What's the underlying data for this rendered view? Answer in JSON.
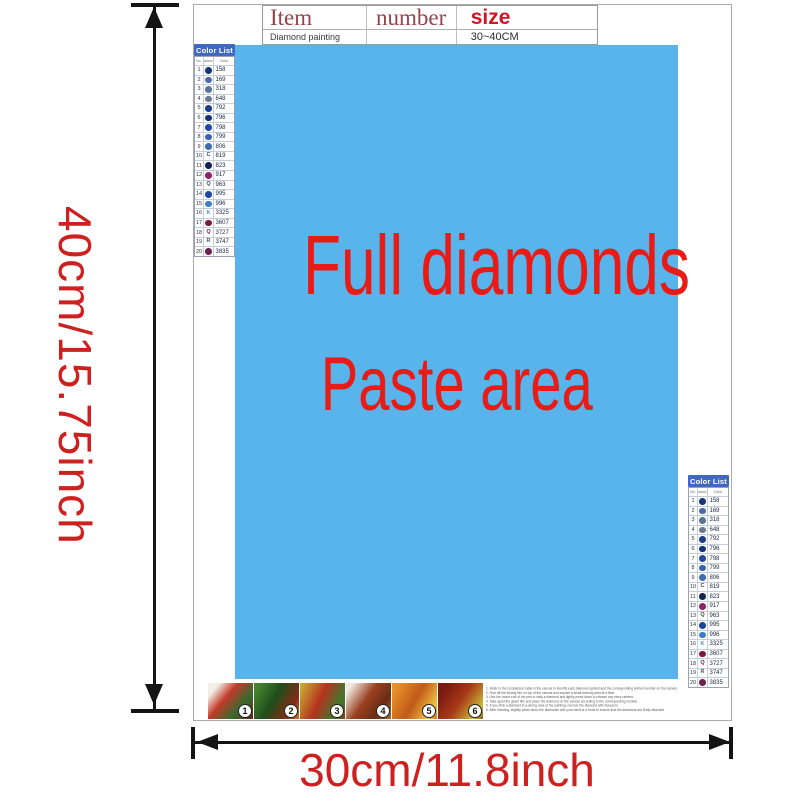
{
  "title_table": {
    "headers": [
      "Item",
      "number",
      "size"
    ],
    "row": [
      "Diamond painting",
      "",
      "30~40CM"
    ]
  },
  "paste_area": {
    "line1": "Full diamonds",
    "line2": "Paste area",
    "bg_color": "#58b4ea",
    "text_color": "#e81b17"
  },
  "dimensions": {
    "height_label": "40cm/15.75inch",
    "width_label": "30cm/11.8inch",
    "color": "#cf2020"
  },
  "color_list": {
    "title": "Color List",
    "header_bg": "#4068c0",
    "columns": [
      "No.",
      "Diamond",
      "Color"
    ],
    "rows": [
      {
        "no": "1",
        "dot": "#16367e",
        "letter": "",
        "code": "158"
      },
      {
        "no": "2",
        "dot": "#4a6aa8",
        "letter": "",
        "code": "169"
      },
      {
        "no": "3",
        "dot": "#5a7498",
        "letter": "",
        "code": "318"
      },
      {
        "no": "4",
        "dot": "#6a7a92",
        "letter": "",
        "code": "648"
      },
      {
        "no": "5",
        "dot": "#1c3c90",
        "letter": "",
        "code": "792"
      },
      {
        "no": "6",
        "dot": "#142f80",
        "letter": "",
        "code": "796"
      },
      {
        "no": "7",
        "dot": "#23479e",
        "letter": "",
        "code": "798"
      },
      {
        "no": "8",
        "dot": "#3a62b2",
        "letter": "",
        "code": "799"
      },
      {
        "no": "9",
        "dot": "#3e6eb0",
        "letter": "",
        "code": "806"
      },
      {
        "no": "10",
        "dot": "",
        "letter": "C",
        "letter_color": "#444444",
        "code": "819"
      },
      {
        "no": "11",
        "dot": "#0e2258",
        "letter": "",
        "code": "823"
      },
      {
        "no": "12",
        "dot": "#8e2464",
        "letter": "",
        "code": "917"
      },
      {
        "no": "13",
        "dot": "",
        "letter": "Q",
        "letter_color": "#444444",
        "code": "963"
      },
      {
        "no": "14",
        "dot": "#1c46a4",
        "letter": "",
        "code": "995"
      },
      {
        "no": "15",
        "dot": "#3c7ecc",
        "letter": "",
        "code": "996"
      },
      {
        "no": "16",
        "dot": "",
        "letter": "K",
        "letter_color": "#4a8cc8",
        "code": "3325"
      },
      {
        "no": "17",
        "dot": "#7a1a3e",
        "letter": "",
        "code": "3607"
      },
      {
        "no": "18",
        "dot": "",
        "letter": "Q",
        "letter_color": "#6a2048",
        "code": "3727"
      },
      {
        "no": "19",
        "dot": "",
        "letter": "R",
        "letter_color": "#555555",
        "code": "3747"
      },
      {
        "no": "20",
        "dot": "#702050",
        "letter": "",
        "code": "3835"
      }
    ]
  },
  "thumbnails": [
    {
      "num": "1",
      "bg": "linear-gradient(130deg,#f2efe6 15%,#c23a2a 40%,#356b2e 70%,#70201a 100%)"
    },
    {
      "num": "2",
      "bg": "linear-gradient(120deg,#46822f 10%,#1e4d1a 45%,#8a2a18 80%,#c87828 100%)"
    },
    {
      "num": "3",
      "bg": "linear-gradient(115deg,#c8a832 5%,#b5321e 45%,#3f7a2e 80%,#7a4018 100%)"
    },
    {
      "num": "4",
      "bg": "linear-gradient(125deg,#efe9e0 10%,#9a4020 45%,#6a2c14 75%,#b06830 100%)"
    },
    {
      "num": "5",
      "bg": "linear-gradient(120deg,#e8902a 10%,#c05a18 50%,#f0c040 85%,#d87820 100%)"
    },
    {
      "num": "6",
      "bg": "linear-gradient(125deg,#7a1a10 15%,#a83818 50%,#c8b838 85%,#8a5a20 100%)"
    }
  ],
  "instructions": {
    "lines": [
      "1. Refer to the comparison table in the canvas to identify each diamond symbol and the corresponding printed number on the canvas.",
      "2. Tear off the folding film on top of the canvas and expose a small working area at a time.",
      "3. Use the round end of the pen to stick a diamond and lightly press down to release any extra cement.",
      "4. Take apart the glued film and place the diamond on the canvas according to the corresponding number.",
      "5. If you stick a diamond in a wrong area of the painting, remove the diamond with tweezers.",
      "6. After finishing, slightly press down the diamonds with your hand or a book to ensure that the diamonds are firmly attached."
    ]
  }
}
